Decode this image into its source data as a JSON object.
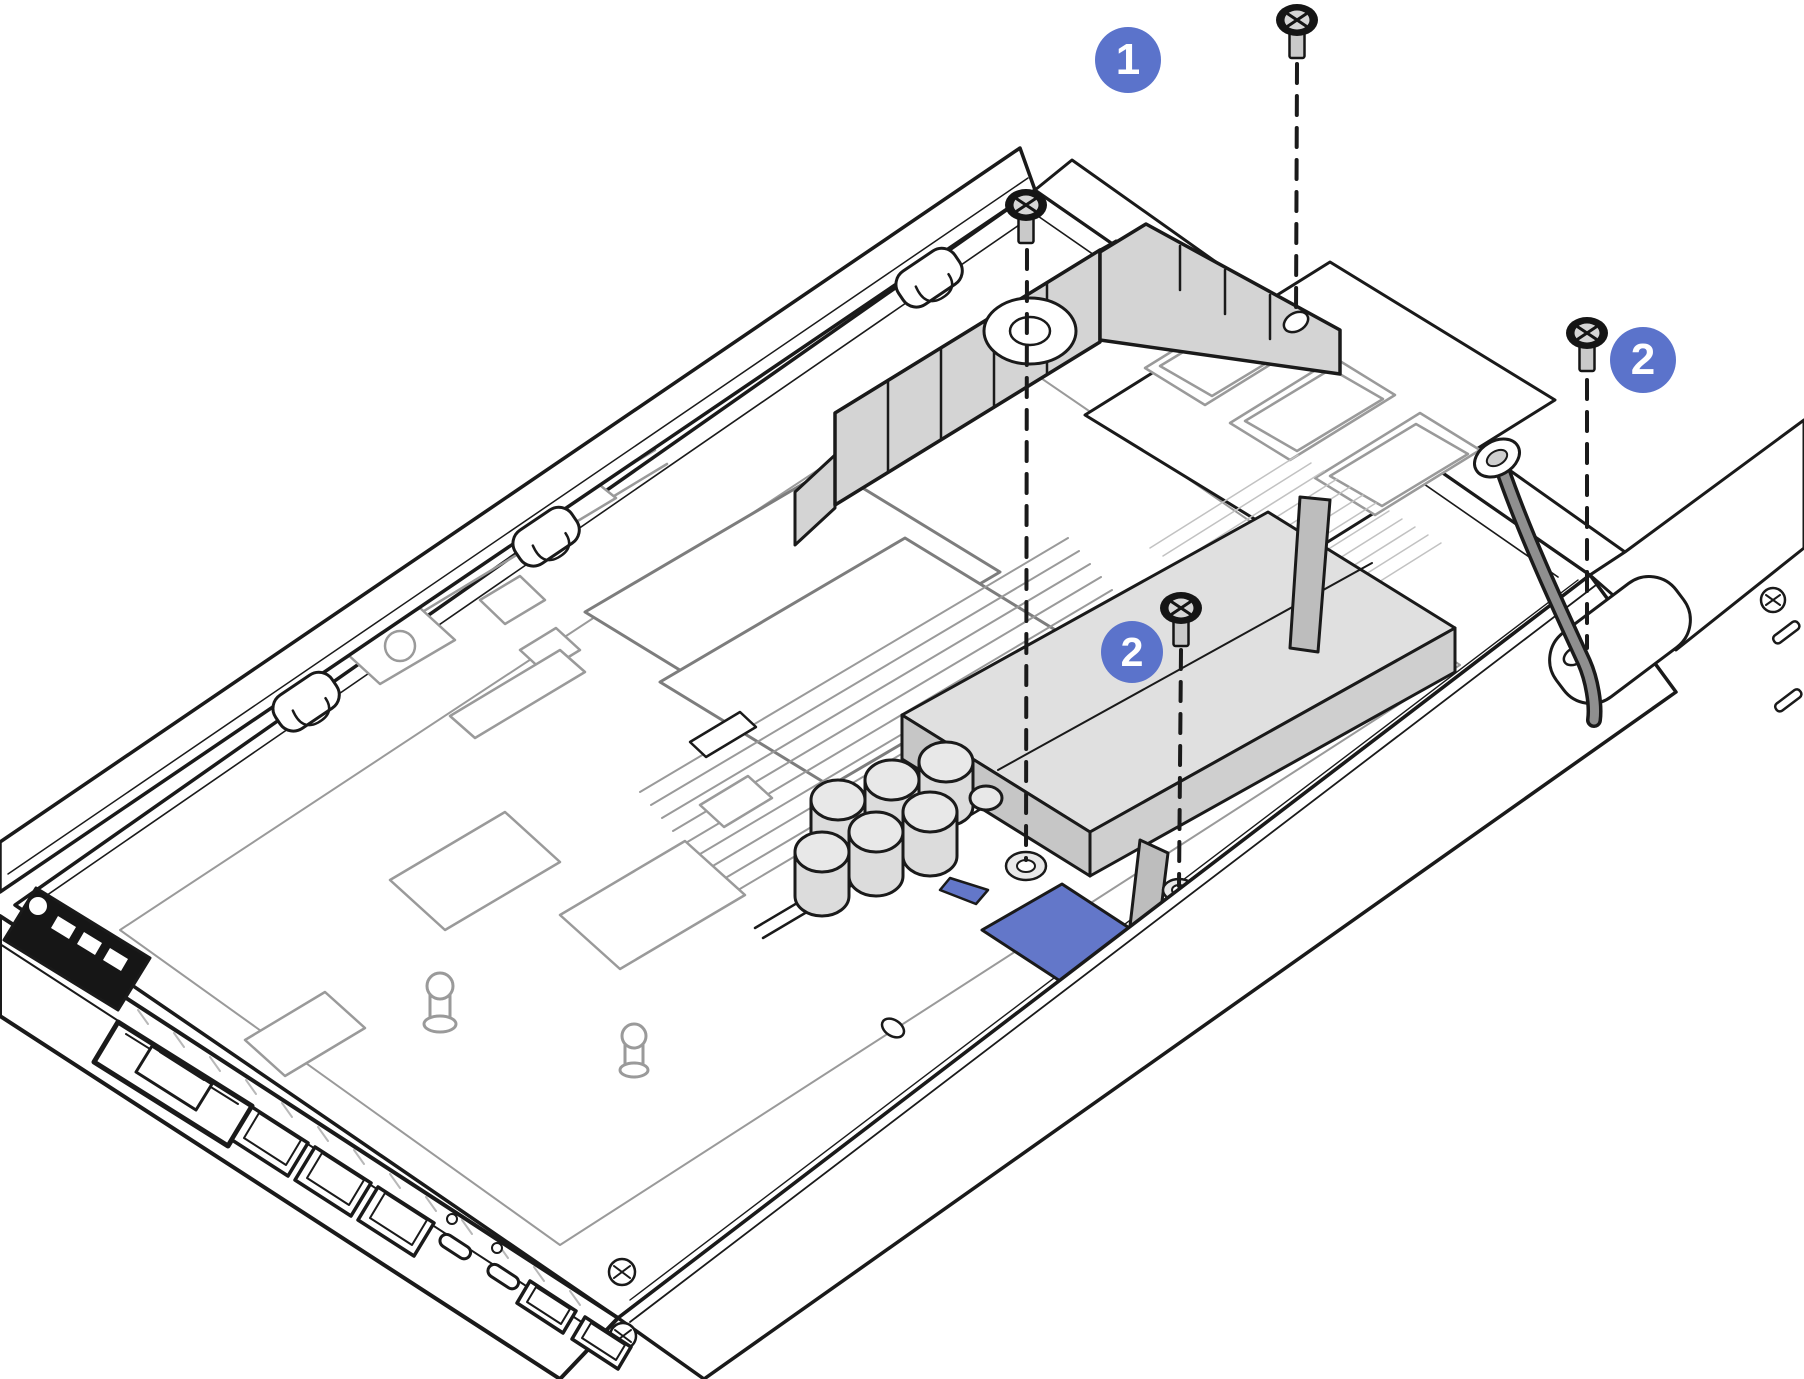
{
  "figure": {
    "kind": "hardware-installation-line-drawing",
    "background_color": "#ffffff",
    "primary_line_color": "#1a1a1a",
    "secondary_line_color": "#9a9a9a",
    "part_fill_gray": "#d4d4d4",
    "cable_gray": "#8f8f8f",
    "callout_blue": "#5b73cb",
    "touch_point_blue": "#6377c9"
  },
  "callouts": [
    {
      "label": "1",
      "x": 1128,
      "y": 60
    },
    {
      "label": "2",
      "x": 1643,
      "y": 360
    },
    {
      "label": "2",
      "x": 1132,
      "y": 652
    }
  ],
  "screws": [
    {
      "name": "screw-top",
      "x": 1297,
      "y": 20,
      "leader_to_y": 318
    },
    {
      "name": "screw-upper-middle",
      "x": 1026,
      "y": 205,
      "leader_to_y": 860
    },
    {
      "name": "screw-right",
      "x": 1587,
      "y": 333,
      "leader_to_y": 648
    },
    {
      "name": "screw-middle",
      "x": 1181,
      "y": 608,
      "leader_to_y": 886
    }
  ],
  "parts": [
    "chassis-tray",
    "rear-wall",
    "front-io-panel",
    "air-baffle",
    "power-module",
    "blue-touch-point",
    "capacitors",
    "power-cable",
    "memory-module-bay",
    "heatsink",
    "dimm-slots",
    "front-latch"
  ]
}
